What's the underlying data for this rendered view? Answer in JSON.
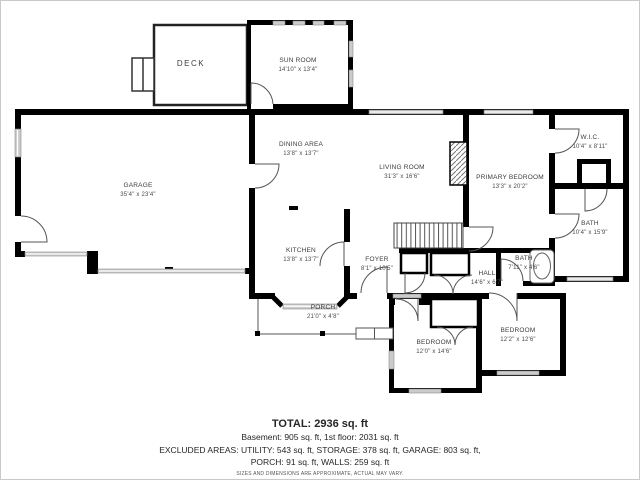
{
  "plan": {
    "rooms": [
      {
        "name": "DECK",
        "dims": ""
      },
      {
        "name": "SUN ROOM",
        "dims": "14'10\" x 13'4\""
      },
      {
        "name": "GARAGE",
        "dims": "35'4\" x 23'4\""
      },
      {
        "name": "DINING AREA",
        "dims": "13'8\" x 13'7\""
      },
      {
        "name": "LIVING ROOM",
        "dims": "31'3\" x 16'6\""
      },
      {
        "name": "PRIMARY BEDROOM",
        "dims": "13'3\" x 20'2\""
      },
      {
        "name": "W.I.C.",
        "dims": "10'4\" x 8'11\""
      },
      {
        "name": "BATH",
        "dims": "10'4\" x 15'9\""
      },
      {
        "name": "KITCHEN",
        "dims": "13'8\" x 13'7\""
      },
      {
        "name": "FOYER",
        "dims": "8'1\" x 10'5\""
      },
      {
        "name": "HALL",
        "dims": "14'6\" x 6'7\""
      },
      {
        "name": "BATH",
        "dims": "7'11\" x 4'6\""
      },
      {
        "name": "PORCH",
        "dims": "21'0\" x 4'8\""
      },
      {
        "name": "BEDROOM",
        "dims": "12'0\" x 14'6\""
      },
      {
        "name": "BEDROOM",
        "dims": "12'2\" x 12'6\""
      }
    ],
    "footer": {
      "total": "TOTAL: 2936 sq. ft",
      "line1": "Basement: 905 sq. ft, 1st floor: 2031 sq. ft",
      "line2": "EXCLUDED AREAS: UTILITY: 543 sq. ft, STORAGE: 378 sq. ft, GARAGE: 803 sq. ft,",
      "line3": "PORCH: 91 sq. ft, WALLS: 259 sq. ft",
      "disclaimer": "SIZES AND DIMENSIONS ARE APPROXIMATE, ACTUAL MAY VARY."
    },
    "colors": {
      "wall": "#000000",
      "window": "#cbcbcb",
      "doorline": "#555555"
    }
  }
}
